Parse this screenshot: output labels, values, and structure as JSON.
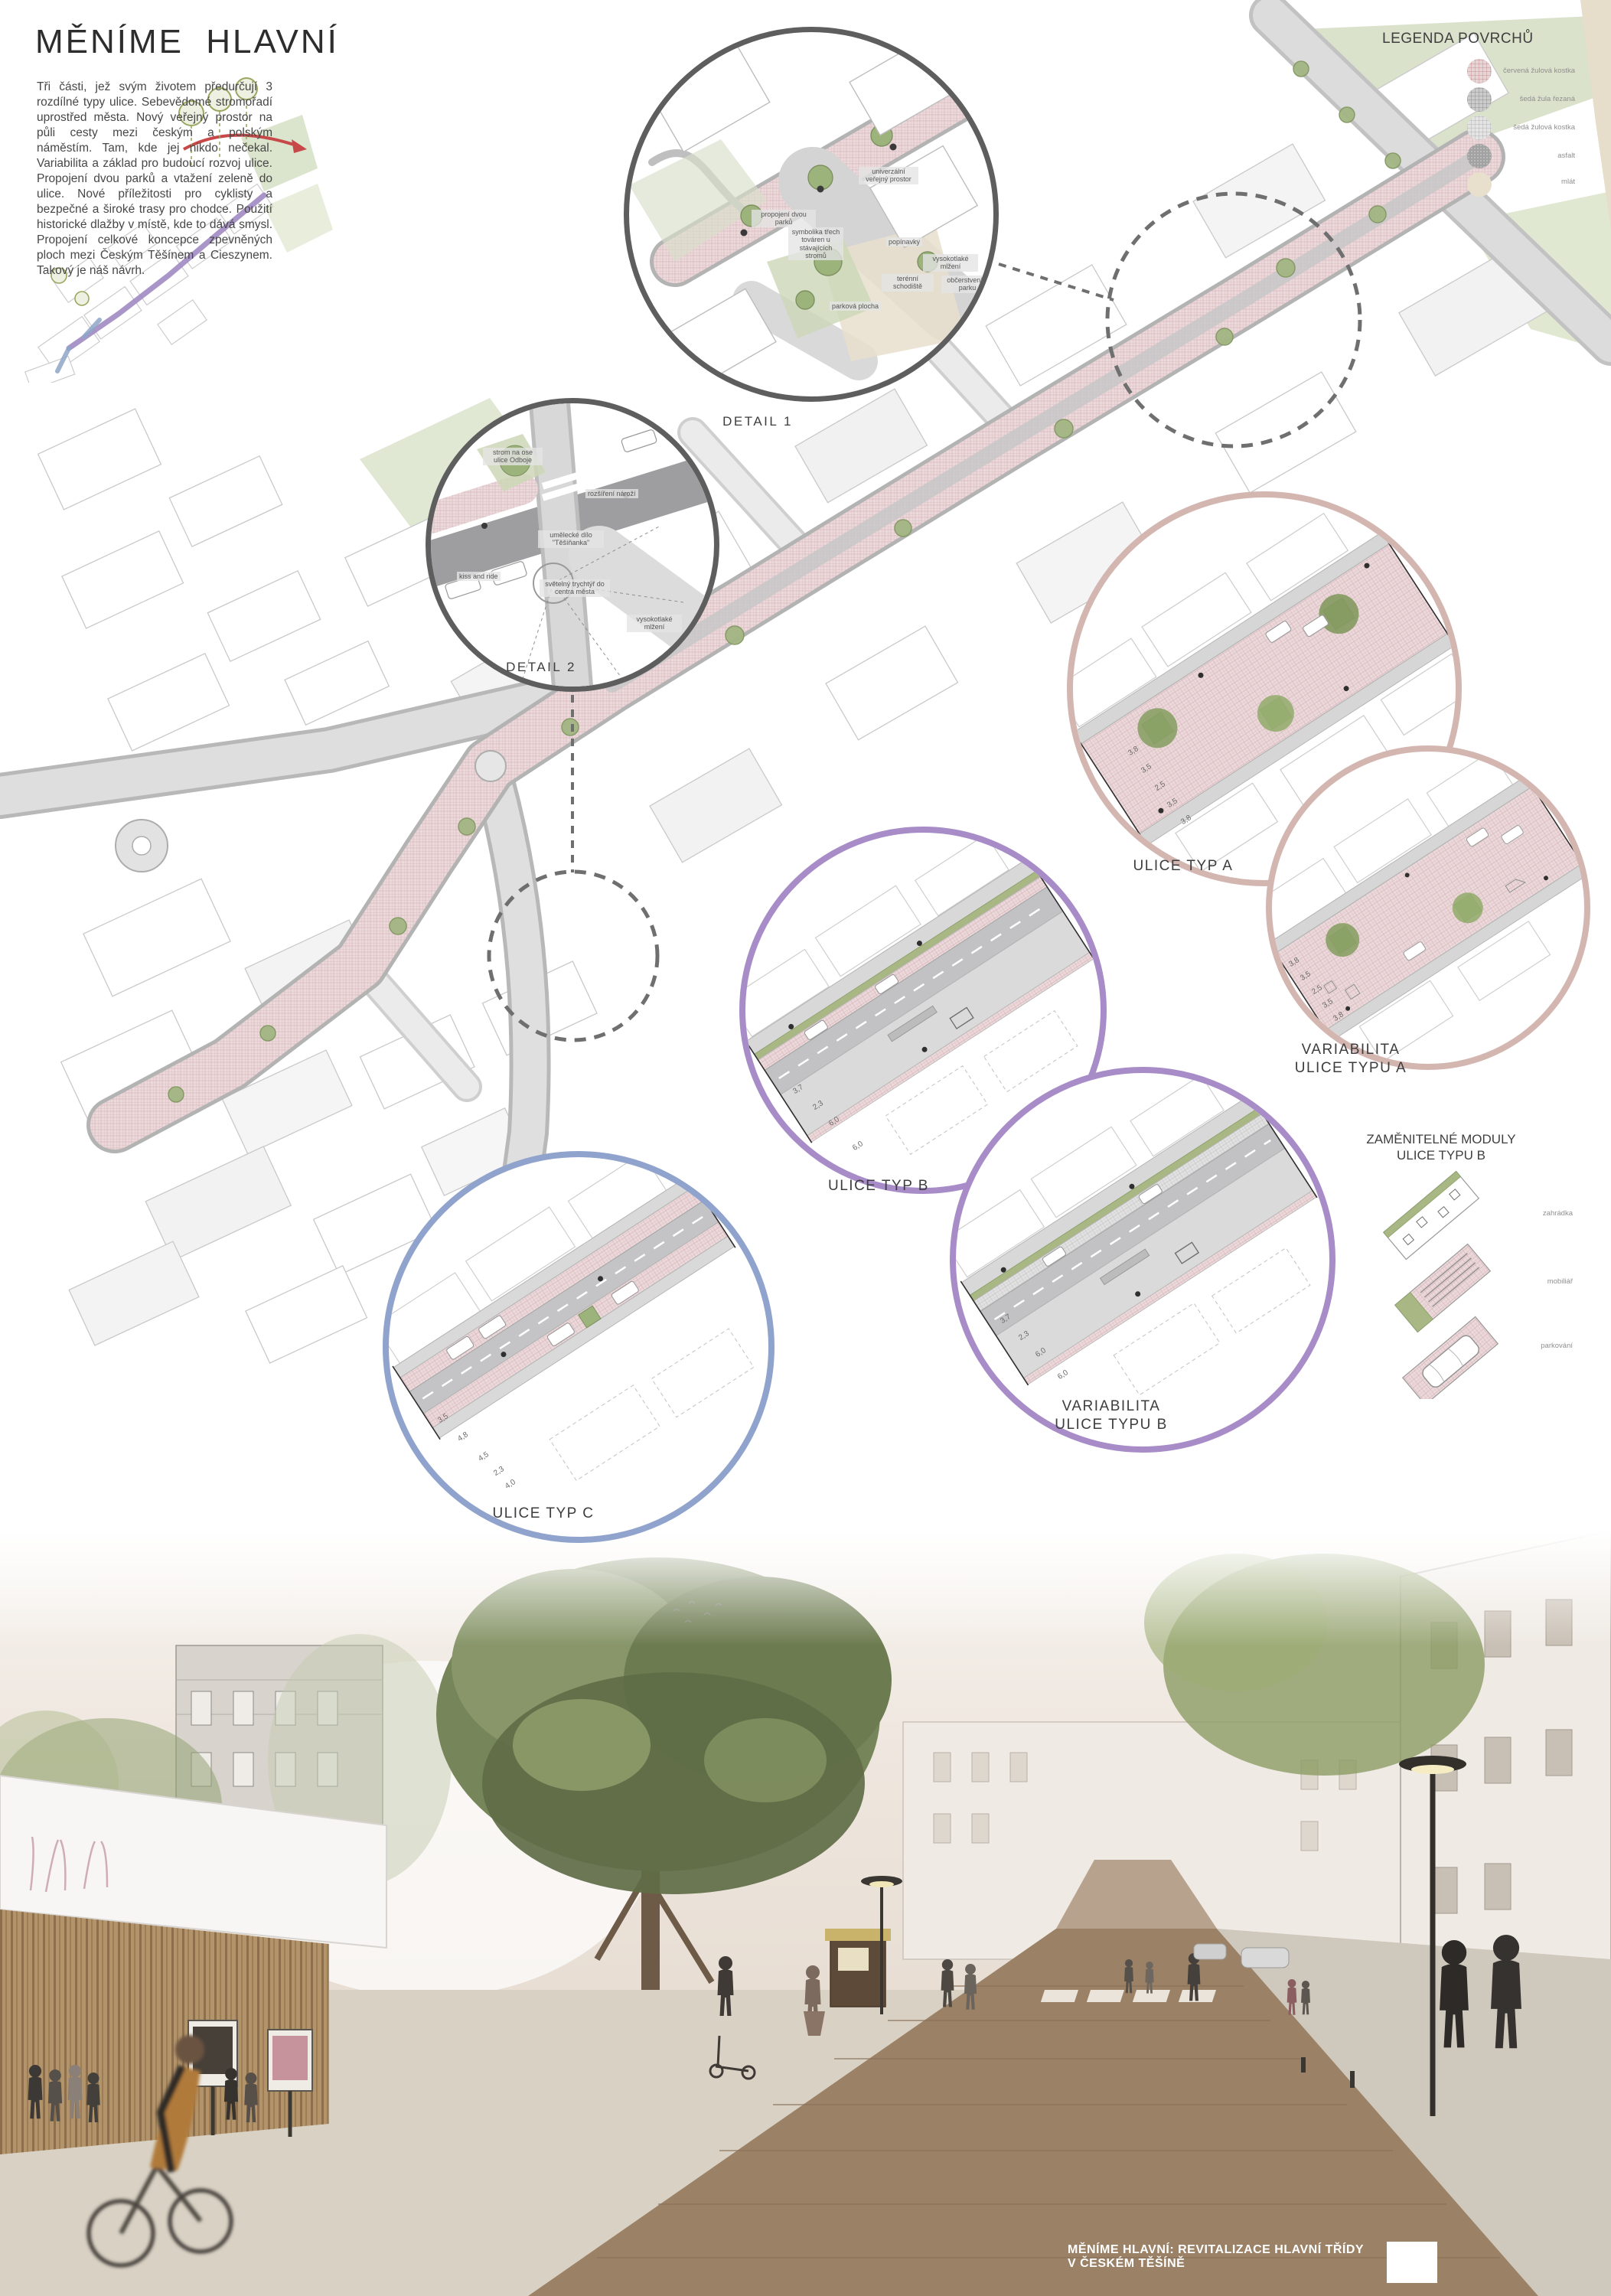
{
  "poster": {
    "title": "MĚNÍME HLAVNÍ",
    "intro": "Tři části, jež svým životem předurčují 3 rozdílné typy ulice. Sebevědomé stromořadí uprostřed města. Nový veřejný prostor na půli cesty mezi českým a polským náměstím. Tam, kde jej nikdo nečekal. Variabilita a základ pro budoucí rozvoj ulice. Propojení dvou parků a vtažení zeleně do ulice. Nové příležitosti pro cyklisty a bezpečné a široké trasy pro chodce. Použití historické dlažby v místě, kde to dává smysl. Propojení celkové koncepce zpevněných ploch mezi Českým Těšínem a Cieszynem. Takový je náš návrh.",
    "footer_caption": "MĚNÍME HLAVNÍ: REVITALIZACE HLAVNÍ TŘÍDY V ČESKÉM TĚŠÍNĚ"
  },
  "legend": {
    "title": "LEGENDA POVRCHŮ",
    "items": [
      {
        "label": "červená žulová kostka",
        "color": "#e7d4d5"
      },
      {
        "label": "šedá žula řezaná",
        "color": "#cbcbcb"
      },
      {
        "label": "šedá žulová kostka",
        "color": "#e4e4e4"
      },
      {
        "label": "asfalt",
        "color": "#a2a2a2"
      },
      {
        "label": "mlát",
        "color": "#e9dfcd"
      }
    ]
  },
  "details": {
    "detail1": {
      "label": "DETAIL 1",
      "annotations": [
        "propojení dvou parků",
        "univerzální veřejný prostor",
        "symbolika třech továren u stávajících stromů",
        "popínavky",
        "vysokotlaké mlžení",
        "terénní schodiště",
        "parková plocha",
        "občerstvení v parku"
      ]
    },
    "detail2": {
      "label": "DETAIL 2",
      "annotations": [
        "strom na ose ulice Odboje",
        "rozšíření nároží",
        "umělecké dílo \"Těšíňanka\"",
        "kiss and ride",
        "světelný trychtýř do centra města",
        "vysokotlaké mlžení"
      ]
    }
  },
  "diagrams": {
    "type_a": {
      "label": "ULICE TYP A",
      "dims": [
        "3,8",
        "3,5",
        "2,5",
        "3,5",
        "3,8"
      ],
      "accent": "#d4b6b1"
    },
    "variability_a": {
      "label_line1": "VARIABILITA",
      "label_line2": "ULICE TYPU A",
      "dims": [
        "3,8",
        "3,5",
        "2,5",
        "3,5",
        "3,8"
      ],
      "accent": "#d4b6b1"
    },
    "type_b": {
      "label": "ULICE TYP B",
      "dims": [
        "3,7",
        "2,3",
        "6,0",
        "6,0"
      ],
      "accent": "#a78cc8"
    },
    "variability_b": {
      "label_line1": "VARIABILITA",
      "label_line2": "ULICE TYPU B",
      "dims": [
        "3,7",
        "2,3",
        "6,0",
        "6,0"
      ],
      "accent": "#a78cc8"
    },
    "type_c": {
      "label": "ULICE TYP C",
      "dims": [
        "3,5",
        "4,8",
        "4,5",
        "2,3",
        "4,0"
      ],
      "accent": "#8fa3cc"
    }
  },
  "modules": {
    "title_line1": "ZAMĚNITELNÉ MODULY",
    "title_line2": "ULICE TYPU B",
    "items": [
      "zahrádka",
      "mobiliář",
      "parkování"
    ]
  },
  "colors": {
    "detail_circle": "#5e5e5e",
    "street_pink": "#ecd9db",
    "green": "#a3b683",
    "photo_road": "#9b8166"
  }
}
